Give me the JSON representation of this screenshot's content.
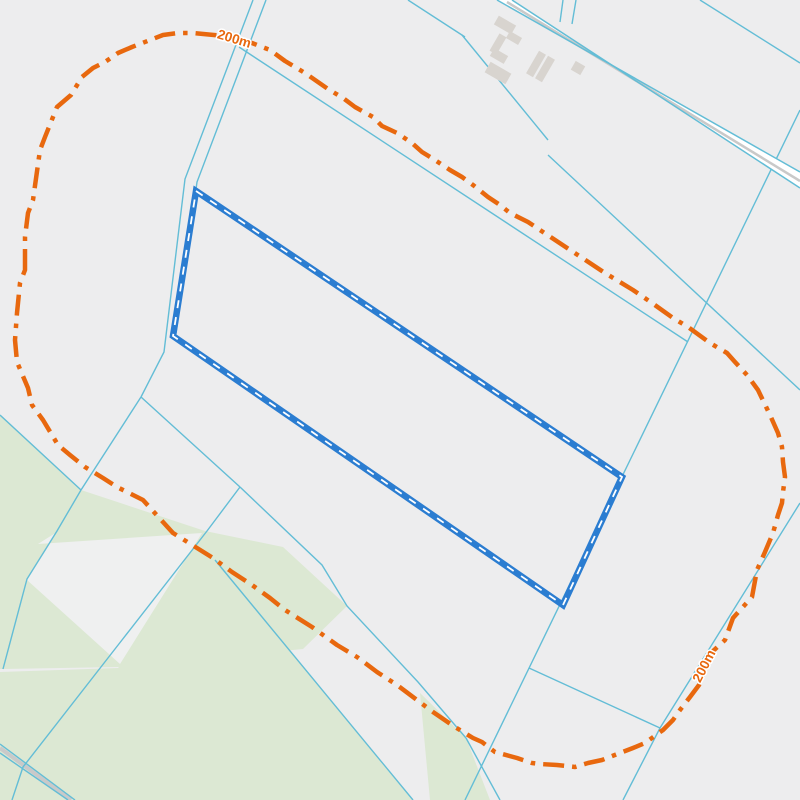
{
  "map": {
    "width": 800,
    "height": 800,
    "colors": {
      "background": "#ededee",
      "field_green": "#dce8d3",
      "cutout_white": "#eff0f0",
      "cadastral_line": "#63bdd6",
      "road_fill": "#ffffff",
      "road_stripe": "#c9c9c9",
      "building": "#d8d4cf",
      "parcel_blue": "#2b7dd1",
      "parcel_dash": "#ffffff",
      "buffer_orange": "#e8680e",
      "label_halo": "#ffffff"
    },
    "green_areas": [
      {
        "name": "field-upper-band",
        "points": [
          [
            0,
            415
          ],
          [
            81,
            490
          ],
          [
            205,
            531
          ],
          [
            283,
            547
          ],
          [
            347,
            606
          ],
          [
            303,
            649
          ],
          [
            118,
            667
          ],
          [
            3,
            669
          ],
          [
            0,
            669
          ]
        ]
      },
      {
        "name": "field-main",
        "points": [
          [
            215,
            560
          ],
          [
            413,
            800
          ],
          [
            0,
            800
          ],
          [
            0,
            672
          ],
          [
            118,
            668
          ]
        ]
      },
      {
        "name": "field-east-sliver",
        "points": [
          [
            420,
            693
          ],
          [
            466,
            738
          ],
          [
            490,
            800
          ],
          [
            430,
            800
          ]
        ]
      }
    ],
    "white_cutouts": [
      {
        "name": "clearing-wedge",
        "points": [
          [
            38,
            544
          ],
          [
            202,
            533
          ],
          [
            120,
            664
          ],
          [
            27,
            580
          ],
          [
            57,
            532
          ]
        ]
      }
    ],
    "cadastral_lines": [
      [
        [
          253,
          0
        ],
        [
          185,
          179
        ],
        [
          164,
          352
        ],
        [
          141,
          397
        ]
      ],
      [
        [
          266,
          0
        ],
        [
          197,
          182
        ],
        [
          176,
          333
        ]
      ],
      [
        [
          141,
          397
        ],
        [
          81,
          490
        ]
      ],
      [
        [
          0,
          415
        ],
        [
          81,
          490
        ]
      ],
      [
        [
          81,
          490
        ],
        [
          57,
          531
        ],
        [
          27,
          579
        ],
        [
          3,
          669
        ]
      ],
      [
        [
          141,
          397
        ],
        [
          240,
          487
        ]
      ],
      [
        [
          240,
          487
        ],
        [
          207,
          531
        ],
        [
          122,
          640
        ],
        [
          23,
          767
        ],
        [
          12,
          800
        ]
      ],
      [
        [
          240,
          487
        ],
        [
          322,
          565
        ],
        [
          347,
          606
        ],
        [
          418,
          682
        ],
        [
          466,
          738
        ]
      ],
      [
        [
          215,
          560
        ],
        [
          413,
          800
        ]
      ],
      [
        [
          466,
          738
        ],
        [
          500,
          800
        ]
      ],
      [
        [
          529,
          668
        ],
        [
          660,
          728
        ]
      ],
      [
        [
          800,
          503
        ],
        [
          660,
          728
        ],
        [
          623,
          800
        ]
      ],
      [
        [
          800,
          110
        ],
        [
          465,
          800
        ]
      ],
      [
        [
          239,
          47
        ],
        [
          688,
          342
        ]
      ],
      [
        [
          548,
          155
        ],
        [
          800,
          390
        ]
      ],
      [
        [
          700,
          0
        ],
        [
          800,
          63
        ]
      ],
      [
        [
          408,
          0
        ],
        [
          465,
          37
        ]
      ],
      [
        [
          462,
          35
        ],
        [
          548,
          140
        ]
      ],
      [
        [
          563,
          0
        ],
        [
          560,
          22
        ]
      ],
      [
        [
          576,
          0
        ],
        [
          572,
          24
        ]
      ],
      [
        [
          0,
          744
        ],
        [
          75,
          800
        ]
      ],
      [
        [
          0,
          753
        ],
        [
          68,
          800
        ]
      ]
    ],
    "gray_paths": [
      {
        "name": "track-bottom-left",
        "points": [
          [
            0,
            748
          ],
          [
            71,
            800
          ]
        ],
        "width": 4
      }
    ],
    "road": {
      "band": [
        [
          497,
          0
        ],
        [
          512,
          0
        ],
        [
          800,
          188
        ],
        [
          800,
          172
        ]
      ],
      "edges": [
        [
          [
            497,
            0
          ],
          [
            800,
            172
          ]
        ],
        [
          [
            512,
            0
          ],
          [
            800,
            188
          ]
        ]
      ],
      "stripe": [
        [
          507,
          2
        ],
        [
          800,
          181
        ]
      ]
    },
    "buildings": [
      {
        "cx": 505,
        "cy": 25,
        "w": 20,
        "h": 10,
        "rot": 30
      },
      {
        "cx": 514,
        "cy": 38,
        "w": 14,
        "h": 8,
        "rot": 30
      },
      {
        "cx": 498,
        "cy": 44,
        "w": 8,
        "h": 20,
        "rot": 30
      },
      {
        "cx": 499,
        "cy": 56,
        "w": 16,
        "h": 9,
        "rot": 30
      },
      {
        "cx": 498,
        "cy": 73,
        "w": 24,
        "h": 12,
        "rot": 30
      },
      {
        "cx": 536,
        "cy": 64,
        "w": 8,
        "h": 26,
        "rot": 30
      },
      {
        "cx": 545,
        "cy": 69,
        "w": 8,
        "h": 26,
        "rot": 30
      },
      {
        "cx": 578,
        "cy": 68,
        "w": 11,
        "h": 10,
        "rot": 30
      }
    ],
    "parcel": {
      "points": [
        [
          196,
          191
        ],
        [
          622,
          477
        ],
        [
          563,
          605
        ],
        [
          173,
          336
        ]
      ],
      "stroke_width": 6.5,
      "dash_width": 1.8,
      "dash_pattern": "8 9"
    },
    "buffer_ring": {
      "label_text": "200m",
      "dash_pattern": "21 8 4.5 8",
      "stroke_width": 4.5,
      "labels": [
        {
          "x": 233,
          "y": 43,
          "rot": 17
        },
        {
          "x": 708,
          "y": 668,
          "rot": -63
        }
      ],
      "points": [
        [
          25,
          270
        ],
        [
          25,
          237
        ],
        [
          28,
          213
        ],
        [
          33,
          200
        ],
        [
          40,
          150
        ],
        [
          45,
          137
        ],
        [
          57,
          107
        ],
        [
          71,
          95
        ],
        [
          82,
          77
        ],
        [
          93,
          68
        ],
        [
          105,
          62
        ],
        [
          118,
          53
        ],
        [
          132,
          47
        ],
        [
          163,
          35
        ],
        [
          178,
          33
        ],
        [
          193,
          33
        ],
        [
          225,
          36
        ],
        [
          252,
          43
        ],
        [
          270,
          50
        ],
        [
          285,
          61
        ],
        [
          305,
          73
        ],
        [
          328,
          89
        ],
        [
          343,
          98
        ],
        [
          355,
          107
        ],
        [
          373,
          117
        ],
        [
          382,
          126
        ],
        [
          397,
          133
        ],
        [
          412,
          143
        ],
        [
          422,
          152
        ],
        [
          435,
          160
        ],
        [
          450,
          170
        ],
        [
          462,
          177
        ],
        [
          473,
          185
        ],
        [
          488,
          197
        ],
        [
          500,
          205
        ],
        [
          510,
          213
        ],
        [
          528,
          222
        ],
        [
          540,
          230
        ],
        [
          605,
          273
        ],
        [
          633,
          290
        ],
        [
          652,
          303
        ],
        [
          673,
          318
        ],
        [
          688,
          327
        ],
        [
          710,
          343
        ],
        [
          727,
          353
        ],
        [
          735,
          362
        ],
        [
          747,
          375
        ],
        [
          758,
          390
        ],
        [
          770,
          415
        ],
        [
          778,
          433
        ],
        [
          782,
          447
        ],
        [
          783,
          462
        ],
        [
          785,
          477
        ],
        [
          783,
          492
        ],
        [
          782,
          503
        ],
        [
          778,
          515
        ],
        [
          773,
          533
        ],
        [
          765,
          552
        ],
        [
          757,
          570
        ],
        [
          752,
          597
        ],
        [
          733,
          618
        ],
        [
          725,
          640
        ],
        [
          712,
          652
        ],
        [
          699,
          685
        ],
        [
          690,
          697
        ],
        [
          680,
          710
        ],
        [
          673,
          720
        ],
        [
          663,
          730
        ],
        [
          645,
          743
        ],
        [
          633,
          748
        ],
        [
          620,
          753
        ],
        [
          602,
          760
        ],
        [
          588,
          763
        ],
        [
          575,
          767
        ],
        [
          557,
          765
        ],
        [
          540,
          764
        ],
        [
          532,
          763
        ],
        [
          517,
          758
        ],
        [
          495,
          752
        ],
        [
          482,
          742
        ],
        [
          473,
          738
        ],
        [
          455,
          727
        ],
        [
          433,
          712
        ],
        [
          417,
          700
        ],
        [
          397,
          685
        ],
        [
          377,
          672
        ],
        [
          357,
          657
        ],
        [
          337,
          645
        ],
        [
          312,
          627
        ],
        [
          285,
          610
        ],
        [
          270,
          598
        ],
        [
          252,
          585
        ],
        [
          232,
          572
        ],
        [
          213,
          558
        ],
        [
          173,
          533
        ],
        [
          143,
          500
        ],
        [
          117,
          487
        ],
        [
          103,
          478
        ],
        [
          85,
          467
        ],
        [
          70,
          455
        ],
        [
          58,
          445
        ],
        [
          43,
          420
        ],
        [
          32,
          405
        ],
        [
          28,
          388
        ],
        [
          17,
          362
        ],
        [
          15,
          340
        ],
        [
          17,
          313
        ],
        [
          20,
          283
        ],
        [
          25,
          270
        ]
      ]
    }
  }
}
